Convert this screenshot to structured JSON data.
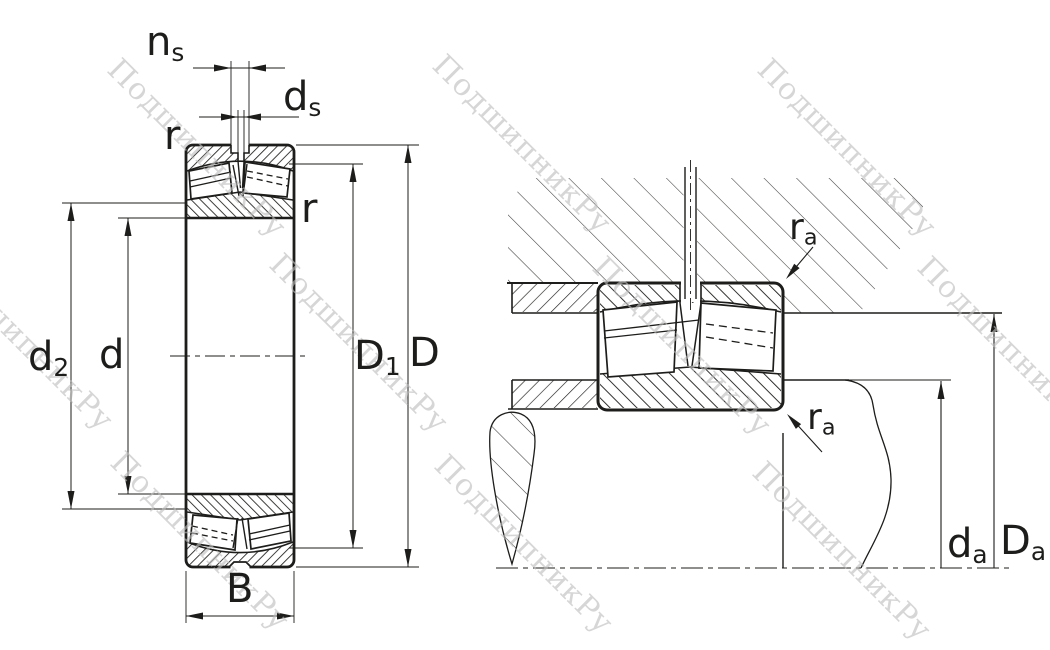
{
  "title": "Spherical roller bearing — dimension drawing and mounting (abutment) drawing",
  "watermark": {
    "text": "ПодшипникРу"
  },
  "labels": {
    "ns": {
      "main": "n",
      "sub": "s"
    },
    "ds": {
      "main": "d",
      "sub": "s"
    },
    "r_left": {
      "main": "r"
    },
    "r_right": {
      "main": "r"
    },
    "d2": {
      "main": "d",
      "sub": "2"
    },
    "d": {
      "main": "d"
    },
    "D1": {
      "main": "D",
      "sub": "1"
    },
    "D": {
      "main": "D"
    },
    "B": {
      "main": "B"
    },
    "ra_top": {
      "main": "r",
      "sub": "a"
    },
    "ra_bottom": {
      "main": "r",
      "sub": "a"
    },
    "da": {
      "main": "d",
      "sub": "a"
    },
    "Da": {
      "main": "D",
      "sub": "a"
    }
  }
}
